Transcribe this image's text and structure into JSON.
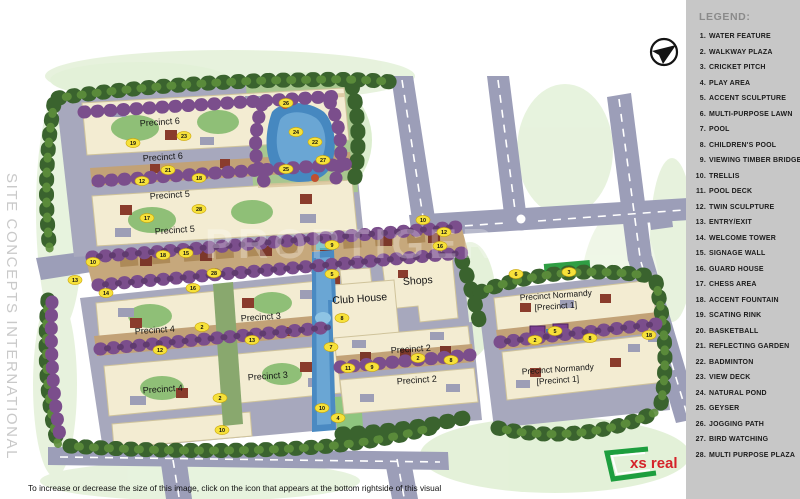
{
  "watermarks": {
    "side_text": "SITE CONCEPTS INTERNATIONAL",
    "map_text": "PROPTIGER"
  },
  "caption": "To increase or decrease the size of this image, click on the icon that appears at the bottom rightside of this visual",
  "branding": {
    "logo_text": "xs real"
  },
  "legend": {
    "title": "LEGEND:",
    "items": [
      {
        "num": "1",
        "label": "WATER FEATURE"
      },
      {
        "num": "2",
        "label": "WALKWAY PLAZA"
      },
      {
        "num": "3",
        "label": "CRICKET PITCH"
      },
      {
        "num": "4",
        "label": "PLAY AREA"
      },
      {
        "num": "5",
        "label": "ACCENT SCULPTURE"
      },
      {
        "num": "6",
        "label": "MULTI-PURPOSE LAWN"
      },
      {
        "num": "7",
        "label": "POOL"
      },
      {
        "num": "8",
        "label": "CHILDREN'S POOL"
      },
      {
        "num": "9",
        "label": "VIEWING TIMBER BRIDGE"
      },
      {
        "num": "10",
        "label": "TRELLIS"
      },
      {
        "num": "11",
        "label": "POOL DECK"
      },
      {
        "num": "12",
        "label": "TWIN SCULPTURE"
      },
      {
        "num": "13",
        "label": "ENTRY/EXIT"
      },
      {
        "num": "14",
        "label": "WELCOME TOWER"
      },
      {
        "num": "15",
        "label": "SIGNAGE WALL"
      },
      {
        "num": "16",
        "label": "GUARD HOUSE"
      },
      {
        "num": "17",
        "label": "CHESS AREA"
      },
      {
        "num": "18",
        "label": "ACCENT FOUNTAIN"
      },
      {
        "num": "19",
        "label": "SCATING RINK"
      },
      {
        "num": "20",
        "label": "BASKETBALL"
      },
      {
        "num": "21",
        "label": "REFLECTING GARDEN"
      },
      {
        "num": "22",
        "label": "BADMINTON"
      },
      {
        "num": "23",
        "label": "VIEW DECK"
      },
      {
        "num": "24",
        "label": "NATURAL POND"
      },
      {
        "num": "25",
        "label": "GEYSER"
      },
      {
        "num": "26",
        "label": "JOGGING PATH"
      },
      {
        "num": "27",
        "label": "BIRD WATCHING"
      },
      {
        "num": "28",
        "label": "MULTI PURPOSE PLAZA"
      }
    ]
  },
  "map": {
    "labels": [
      {
        "text": "Precinct 6",
        "x": 160,
        "y": 125,
        "size": 9
      },
      {
        "text": "Precinct 6",
        "x": 163,
        "y": 160,
        "size": 9
      },
      {
        "text": "Precinct 5",
        "x": 170,
        "y": 198,
        "size": 9
      },
      {
        "text": "Precinct 5",
        "x": 175,
        "y": 233,
        "size": 9
      },
      {
        "text": "Precinct 4",
        "x": 155,
        "y": 333,
        "size": 9
      },
      {
        "text": "Precinct 4",
        "x": 163,
        "y": 392,
        "size": 9
      },
      {
        "text": "Precinct 3",
        "x": 261,
        "y": 320,
        "size": 9
      },
      {
        "text": "Precinct 3",
        "x": 268,
        "y": 379,
        "size": 9
      },
      {
        "text": "Precinct 2",
        "x": 411,
        "y": 352,
        "size": 9
      },
      {
        "text": "Precinct 2",
        "x": 417,
        "y": 383,
        "size": 9
      },
      {
        "text": "Club House",
        "x": 360,
        "y": 302,
        "size": 10.5
      },
      {
        "text": "Shops",
        "x": 418,
        "y": 284,
        "size": 10.5
      },
      {
        "text": "Precinct Normandy",
        "x": 556,
        "y": 298,
        "size": 8.5
      },
      {
        "text": "[Precinct 1]",
        "x": 556,
        "y": 309,
        "size": 8.5
      },
      {
        "text": "Precinct Normandy",
        "x": 558,
        "y": 372,
        "size": 8.5
      },
      {
        "text": "[Precinct 1]",
        "x": 558,
        "y": 383,
        "size": 8.5
      }
    ],
    "markers": [
      {
        "n": 19,
        "x": 133,
        "y": 143
      },
      {
        "n": 23,
        "x": 184,
        "y": 136
      },
      {
        "n": 21,
        "x": 168,
        "y": 170
      },
      {
        "n": 12,
        "x": 142,
        "y": 181
      },
      {
        "n": 18,
        "x": 199,
        "y": 178
      },
      {
        "n": 17,
        "x": 147,
        "y": 218
      },
      {
        "n": 28,
        "x": 199,
        "y": 209
      },
      {
        "n": 13,
        "x": 75,
        "y": 280
      },
      {
        "n": 10,
        "x": 93,
        "y": 262
      },
      {
        "n": 18,
        "x": 163,
        "y": 255
      },
      {
        "n": 15,
        "x": 186,
        "y": 253
      },
      {
        "n": 14,
        "x": 106,
        "y": 293
      },
      {
        "n": 16,
        "x": 193,
        "y": 288
      },
      {
        "n": 28,
        "x": 214,
        "y": 273
      },
      {
        "n": 26,
        "x": 286,
        "y": 103
      },
      {
        "n": 24,
        "x": 296,
        "y": 132
      },
      {
        "n": 22,
        "x": 315,
        "y": 142
      },
      {
        "n": 27,
        "x": 323,
        "y": 160
      },
      {
        "n": 25,
        "x": 286,
        "y": 169
      },
      {
        "n": 9,
        "x": 332,
        "y": 245
      },
      {
        "n": 10,
        "x": 423,
        "y": 220
      },
      {
        "n": 12,
        "x": 444,
        "y": 232
      },
      {
        "n": 16,
        "x": 440,
        "y": 246
      },
      {
        "n": 5,
        "x": 332,
        "y": 274
      },
      {
        "n": 8,
        "x": 342,
        "y": 318
      },
      {
        "n": 7,
        "x": 331,
        "y": 347
      },
      {
        "n": 11,
        "x": 348,
        "y": 368
      },
      {
        "n": 4,
        "x": 338,
        "y": 418
      },
      {
        "n": 10,
        "x": 322,
        "y": 408
      },
      {
        "n": 2,
        "x": 418,
        "y": 358
      },
      {
        "n": 8,
        "x": 451,
        "y": 360
      },
      {
        "n": 9,
        "x": 372,
        "y": 367
      },
      {
        "n": 2,
        "x": 202,
        "y": 327
      },
      {
        "n": 12,
        "x": 160,
        "y": 350
      },
      {
        "n": 13,
        "x": 252,
        "y": 340
      },
      {
        "n": 2,
        "x": 220,
        "y": 398
      },
      {
        "n": 10,
        "x": 222,
        "y": 430
      },
      {
        "n": 6,
        "x": 516,
        "y": 274
      },
      {
        "n": 3,
        "x": 569,
        "y": 272
      },
      {
        "n": 5,
        "x": 555,
        "y": 331
      },
      {
        "n": 2,
        "x": 535,
        "y": 340
      },
      {
        "n": 8,
        "x": 590,
        "y": 338
      },
      {
        "n": 18,
        "x": 649,
        "y": 335
      }
    ],
    "colors": {
      "legend_bg": "#c7c7c7",
      "road": "#9c9eb8",
      "building": "#f3ecd2",
      "water": "#4a8ac2",
      "tree_dark": "#3a632e",
      "tree_purple": "#7b4e8c",
      "marker": "#f6e13a",
      "logo_red": "#d5232a",
      "logo_green": "#1d9e3e"
    }
  }
}
